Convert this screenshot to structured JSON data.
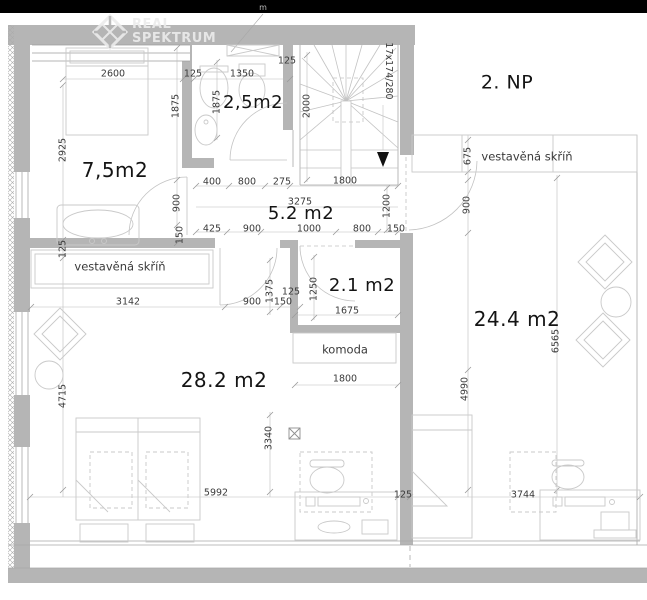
{
  "floor_title": "2. NP",
  "logo": {
    "line1": "REAL",
    "line2": "SPEKTRUM"
  },
  "rooms": [
    {
      "id": "bedroom-left",
      "label": "7,5m2"
    },
    {
      "id": "bathroom",
      "label": "2,5m2"
    },
    {
      "id": "hallway",
      "label": "5.2 m2"
    },
    {
      "id": "closet",
      "label": "2.1 m2"
    },
    {
      "id": "bedroom-main",
      "label": "28.2 m2"
    },
    {
      "id": "living-right",
      "label": "24.4 m2"
    }
  ],
  "features": {
    "wardrobe_left": "vestavěná skříň",
    "wardrobe_right": "vestavěná skříň",
    "dresser": "komoda",
    "stairs_spec": "17x174/280"
  },
  "colors": {
    "bar": "#000000",
    "wall": "#b5b5b5",
    "line": "#a8a8a8",
    "furniture": "#c9c9c9",
    "dimline": "#bcbcbc",
    "dimtext": "#3a3a3a",
    "roomtext": "#141414",
    "logocolor": "#ececec"
  },
  "labels": [
    {
      "n": "room-label-7-5m2",
      "t": "7,5m2",
      "x": 115,
      "y": 170,
      "s": 20,
      "c": "room"
    },
    {
      "n": "room-label-2-5m2",
      "t": "2,5m2",
      "x": 253,
      "y": 103,
      "s": 18,
      "c": "room"
    },
    {
      "n": "room-label-5-2m2",
      "t": "5.2 m2",
      "x": 301,
      "y": 214,
      "s": 18,
      "c": "room"
    },
    {
      "n": "room-label-2-1m2",
      "t": "2.1 m2",
      "x": 362,
      "y": 286,
      "s": 18,
      "c": "room"
    },
    {
      "n": "room-label-28-2m2",
      "t": "28.2 m2",
      "x": 224,
      "y": 380,
      "s": 20,
      "c": "room"
    },
    {
      "n": "room-label-24-4m2",
      "t": "24.4 m2",
      "x": 517,
      "y": 319,
      "s": 20,
      "c": "room"
    },
    {
      "n": "floor-title",
      "t": "2. NP",
      "x": 507,
      "y": 83,
      "s": 19,
      "c": "room"
    },
    {
      "n": "wardrobe-left-label",
      "t": "vestavěná skříň",
      "x": 120,
      "y": 267,
      "s": 11.5
    },
    {
      "n": "wardrobe-right-label",
      "t": "vestavěná skříň",
      "x": 527,
      "y": 157,
      "s": 11.5
    },
    {
      "n": "dresser-label",
      "t": "komoda",
      "x": 345,
      "y": 350,
      "s": 11.5
    },
    {
      "n": "ceiling-note",
      "t": "m",
      "x": 263,
      "y": 8,
      "s": 8,
      "col": "#bbbbbb"
    },
    {
      "t": "2600",
      "x": 113,
      "y": 74
    },
    {
      "t": "125",
      "x": 193,
      "y": 74
    },
    {
      "t": "1350",
      "x": 242,
      "y": 74
    },
    {
      "t": "125",
      "x": 287,
      "y": 61
    },
    {
      "t": "1875",
      "x": 176,
      "y": 106,
      "r": -90
    },
    {
      "t": "1875",
      "x": 217,
      "y": 102,
      "r": -90
    },
    {
      "t": "2925",
      "x": 63,
      "y": 150,
      "r": -90
    },
    {
      "t": "900",
      "x": 177,
      "y": 203,
      "r": -90
    },
    {
      "t": "150",
      "x": 180,
      "y": 235,
      "r": -90
    },
    {
      "t": "2000",
      "x": 307,
      "y": 106,
      "r": -90
    },
    {
      "t": "17x174/280",
      "x": 388,
      "y": 71,
      "r": 90
    },
    {
      "t": "400",
      "x": 212,
      "y": 182
    },
    {
      "t": "800",
      "x": 247,
      "y": 182
    },
    {
      "t": "275",
      "x": 282,
      "y": 182
    },
    {
      "t": "1800",
      "x": 345,
      "y": 181
    },
    {
      "t": "3275",
      "x": 300,
      "y": 202
    },
    {
      "t": "425",
      "x": 212,
      "y": 229
    },
    {
      "t": "900",
      "x": 252,
      "y": 229
    },
    {
      "t": "1000",
      "x": 309,
      "y": 229
    },
    {
      "t": "800",
      "x": 362,
      "y": 229
    },
    {
      "t": "150",
      "x": 396,
      "y": 229
    },
    {
      "t": "1200",
      "x": 387,
      "y": 206,
      "r": -90
    },
    {
      "t": "125",
      "x": 63,
      "y": 249,
      "r": -90
    },
    {
      "t": "3142",
      "x": 128,
      "y": 302
    },
    {
      "t": "900",
      "x": 252,
      "y": 302
    },
    {
      "t": "1375",
      "x": 270,
      "y": 291,
      "r": -90
    },
    {
      "t": "125",
      "x": 291,
      "y": 292
    },
    {
      "t": "150",
      "x": 283,
      "y": 302
    },
    {
      "t": "1250",
      "x": 314,
      "y": 289,
      "r": -90
    },
    {
      "t": "1675",
      "x": 347,
      "y": 311
    },
    {
      "t": "1800",
      "x": 345,
      "y": 379
    },
    {
      "t": "4715",
      "x": 63,
      "y": 396,
      "r": -90
    },
    {
      "t": "3340",
      "x": 269,
      "y": 438,
      "r": -90
    },
    {
      "t": "5992",
      "x": 216,
      "y": 493
    },
    {
      "t": "675",
      "x": 468,
      "y": 156,
      "r": -90
    },
    {
      "t": "900",
      "x": 467,
      "y": 205,
      "r": -90
    },
    {
      "t": "6565",
      "x": 556,
      "y": 341,
      "r": -90
    },
    {
      "t": "4990",
      "x": 465,
      "y": 389,
      "r": -90
    },
    {
      "t": "125",
      "x": 403,
      "y": 495
    },
    {
      "t": "3744",
      "x": 523,
      "y": 495
    }
  ]
}
